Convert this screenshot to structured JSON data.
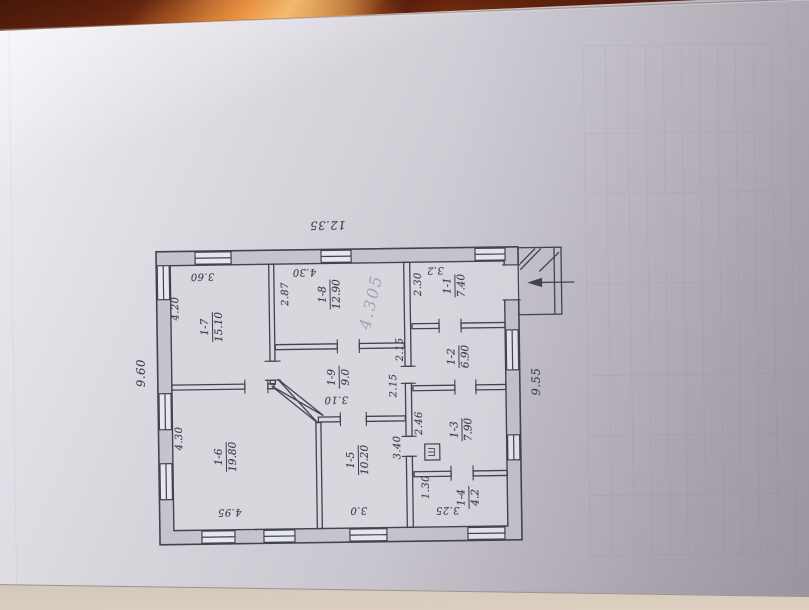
{
  "scene": {
    "description": "Photo of a hand-drawn house floor plan on a sheet lying on a wooden table",
    "colors": {
      "wood": "#7c2e11",
      "wood_highlight": "#eb9340",
      "paper": "#d6d3db",
      "ink": "#3f4451",
      "pencil": "#8b919f",
      "table_band": "#ddd0bf"
    }
  },
  "plan": {
    "overall_dimensions": [
      "12.35",
      "9.60",
      "9.55"
    ],
    "rooms": [
      {
        "number": "1-1",
        "area": "7.40"
      },
      {
        "number": "1-2",
        "area": "6.90"
      },
      {
        "number": "1-3",
        "area": "7.90"
      },
      {
        "number": "1-4",
        "area": "4.2"
      },
      {
        "number": "1-5",
        "area": "10.20"
      },
      {
        "number": "1-6",
        "area": "19.80"
      },
      {
        "number": "1-7",
        "area": "15.10"
      },
      {
        "number": "1-8",
        "area": "12.90"
      },
      {
        "number": "1-9",
        "area": "9.0"
      }
    ],
    "dimensions": [
      "3.60",
      "4.20",
      "4.30",
      "2.87",
      "3.2",
      "2.30",
      "2.15",
      "2.15",
      "3.10",
      "2.46",
      "3.40",
      "3.0",
      "4.95",
      "4.30",
      "1.30",
      "3.25"
    ],
    "annotations": {
      "pencil_note": "4.305",
      "shaft_symbol": "Ш"
    }
  }
}
